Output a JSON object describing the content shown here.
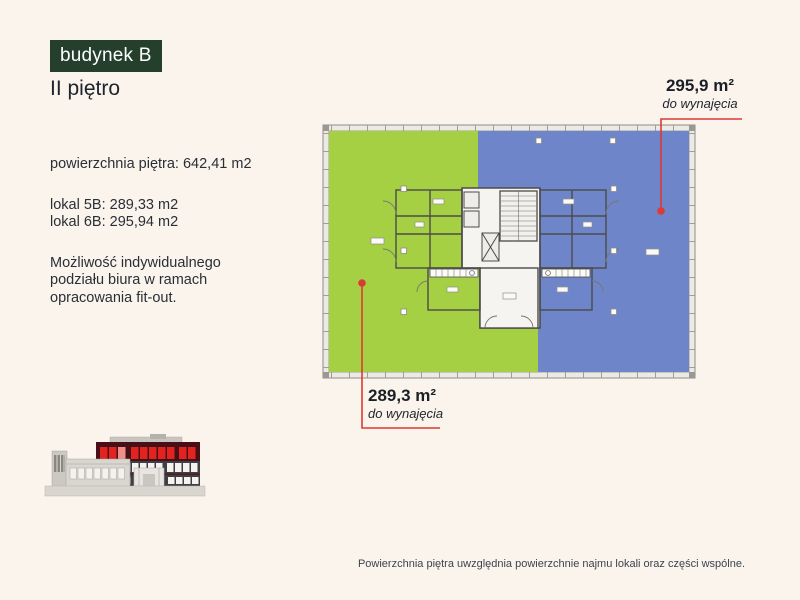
{
  "page": {
    "background_color": "#fbf4ec"
  },
  "header": {
    "building_badge": "budynek B",
    "floor_title": "II piętro"
  },
  "info_panel": {
    "floor_area": "powierzchnia piętra: 642,41 m2",
    "unit_lines": [
      "lokal 5B: 289,33 m2",
      "lokal 6B: 295,94 m2"
    ],
    "note_lines": [
      "Możliwość indywidualnego",
      "podziału biura w ramach",
      "opracowania fit-out."
    ]
  },
  "floor_plan": {
    "unit_6b": {
      "area": "295,9 m²",
      "availability": "do wynajęcia"
    },
    "unit_5b": {
      "area": "289,3 m²",
      "availability": "do wynajęcia"
    },
    "colors": {
      "unit_5b_fill": "#a6d044",
      "unit_6b_fill": "#6e86c9",
      "leader_red": "#dd3a35",
      "highlight_floor_red": "#e2231f",
      "badge_green": "#24402c"
    }
  },
  "footer": {
    "disclaimer": "Powierzchnia piętra uwzględnia powierzchnie najmu lokali oraz części wspólne."
  }
}
